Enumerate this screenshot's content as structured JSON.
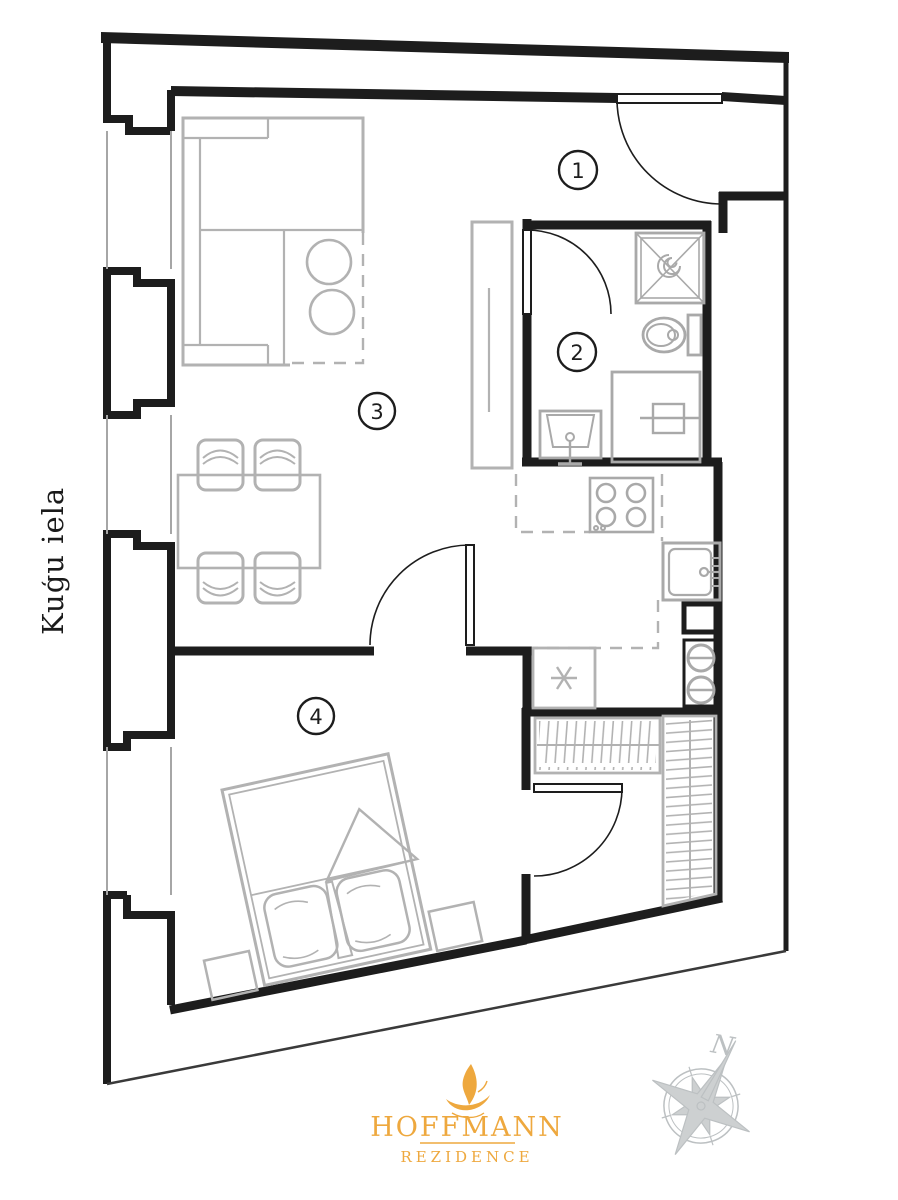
{
  "plan": {
    "street_label": "Kuģu iela",
    "rooms": [
      {
        "number": "1"
      },
      {
        "number": "2"
      },
      {
        "number": "3"
      },
      {
        "number": "4"
      }
    ],
    "compass": {
      "north_label": "N"
    },
    "logo": {
      "name": "HOFFMANN",
      "subtitle": "REZIDENCE"
    },
    "colors": {
      "wall": "#1d1d1d",
      "window_line": "#a6a6a6",
      "furniture": "#b2b2b2",
      "fixture": "#a9a9a9",
      "compass_gray": "#bcc0c2",
      "logo_gold": "#EEA83E"
    }
  }
}
